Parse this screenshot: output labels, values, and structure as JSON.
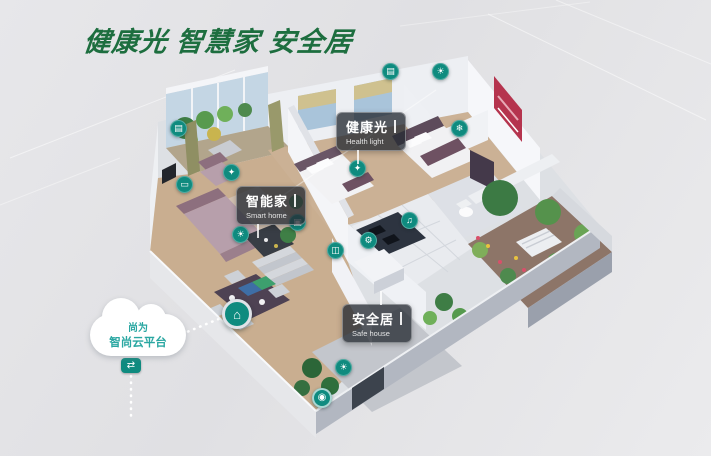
{
  "title": {
    "text": "健康光 智慧家 安全居"
  },
  "zone_labels": {
    "health_light": {
      "zh": "健康光",
      "en": "Health light"
    },
    "smart_home": {
      "zh": "智能家",
      "en": "Smart home"
    },
    "safe_house": {
      "zh": "安全居",
      "en": "Safe house"
    }
  },
  "cloud_platform": {
    "line1": "尚为",
    "line2": "智尚云平台"
  },
  "device_icons": {
    "curtain_balcony": {
      "glyph": "▤"
    },
    "tv_living": {
      "glyph": "▭"
    },
    "lamp_living": {
      "glyph": "✦"
    },
    "light_living": {
      "glyph": "☀"
    },
    "curtain_bedroom": {
      "glyph": "▤"
    },
    "light_bedroom": {
      "glyph": "☀"
    },
    "scene_bedroom": {
      "glyph": "✦"
    },
    "ac_bedroom": {
      "glyph": "❄"
    },
    "switch_hall": {
      "glyph": "▣"
    },
    "window_kitchen": {
      "glyph": "◫"
    },
    "appliance_kitchen": {
      "glyph": "⚙"
    },
    "speaker_kitchen": {
      "glyph": "♫"
    },
    "light_entrance": {
      "glyph": "☀"
    },
    "door_lock_entrance": {
      "glyph": "◉"
    },
    "gateway_hub": {
      "glyph": "⌂"
    },
    "cloud_link": {
      "glyph": "⇄"
    }
  },
  "colors": {
    "title_green": "#1d6e3f",
    "device_teal": "#0f8b7f",
    "cloud_text_teal": "#2aa7a2",
    "label_bg": "#272b33c7"
  }
}
